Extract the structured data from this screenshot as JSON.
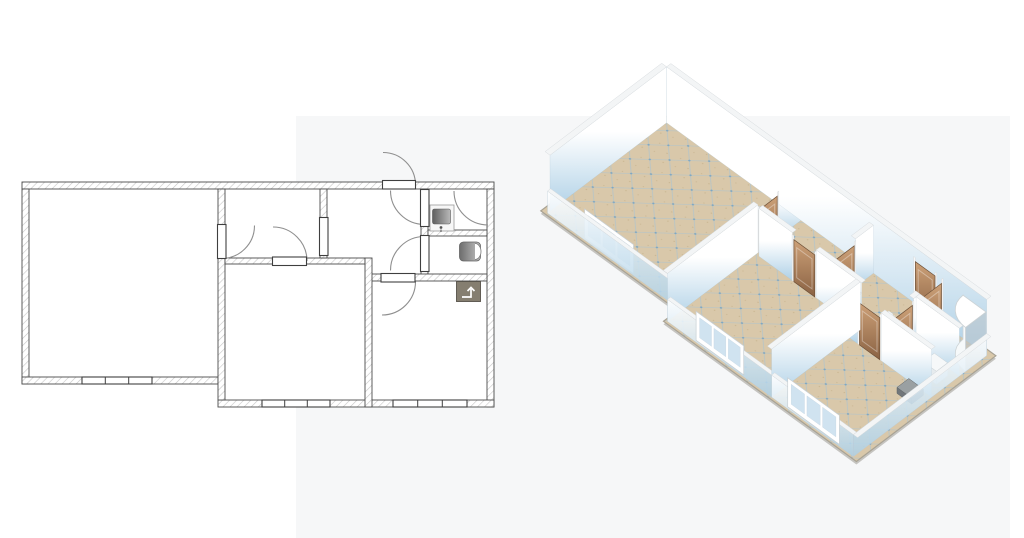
{
  "scene": {
    "width": 1024,
    "height": 538,
    "background": "#ffffff",
    "tint": {
      "x": 296,
      "y": 116,
      "w": 714,
      "h": 422,
      "color": "#eef0f2",
      "opacity": 0.5
    }
  },
  "plan2d": {
    "backing": {
      "x": 22,
      "y": 182,
      "w": 472,
      "h": 225,
      "color": "#ffffff"
    },
    "wall_fill": "#ffffff",
    "wall_stroke": "#4b4b4b",
    "hatch_color": "#c6c6c6",
    "bar_stroke": "#3f3f3f",
    "arc_color": "#8f8f8f",
    "walls": [
      [
        22,
        182,
        472,
        7
      ],
      [
        22,
        189,
        7,
        195
      ],
      [
        22,
        377,
        196,
        7
      ],
      [
        487,
        189,
        7,
        218
      ],
      [
        218,
        400,
        276,
        7
      ],
      [
        218,
        189,
        7,
        211
      ],
      [
        225,
        258,
        140,
        6
      ],
      [
        320,
        189,
        7,
        69
      ],
      [
        421,
        189,
        7,
        88
      ],
      [
        428,
        230,
        59,
        6
      ],
      [
        368,
        274,
        119,
        7
      ],
      [
        365,
        258,
        7,
        149
      ]
    ],
    "door_bars": [
      {
        "name": "entrance-door",
        "bar": [
          382.5,
          180.5,
          33,
          8.5
        ],
        "arc": {
          "from": [
            383,
            152.5
          ],
          "to": [
            415.5,
            185
          ],
          "r": 32.5,
          "sweep": 1
        }
      },
      {
        "name": "living-room-door",
        "bar": [
          217.5,
          224.5,
          8.5,
          34
        ],
        "arc": {
          "from": [
            254.5,
            225.5
          ],
          "to": [
            221.5,
            258.5
          ],
          "r": 33,
          "sweep": 1
        }
      },
      {
        "name": "bedroom-door",
        "bar": [
          272.5,
          257,
          34,
          8.5
        ],
        "arc": {
          "from": [
            273,
            227
          ],
          "to": [
            307,
            261
          ],
          "r": 34,
          "sweep": 1
        }
      },
      {
        "name": "bathroom-door",
        "bar": [
          420.5,
          189.5,
          8.5,
          37
        ],
        "arc": {
          "from": [
            390.5,
            190.5
          ],
          "to": [
            424.5,
            224.5
          ],
          "r": 34,
          "sweep": 0
        }
      },
      {
        "name": "toilet-door",
        "bar": [
          420.5,
          235.5,
          8.5,
          36
        ],
        "arc": {
          "from": [
            424.5,
            236.5
          ],
          "to": [
            390.5,
            270.5
          ],
          "r": 34,
          "sweep": 0
        }
      },
      {
        "name": "second-bedroom-door",
        "bar": [
          381,
          273.5,
          34,
          8.5
        ],
        "arc": {
          "from": [
            415.5,
            281.5
          ],
          "to": [
            382,
            315
          ],
          "r": 33.5,
          "sweep": 1
        }
      }
    ],
    "openings": [
      {
        "name": "hall-cased-opening",
        "bar": [
          319.5,
          217.5,
          8.5,
          38
        ]
      }
    ],
    "windows": [
      {
        "bar": [
          82,
          377,
          70,
          7
        ],
        "dividers": [
          105.3,
          128.7
        ]
      },
      {
        "bar": [
          262,
          400,
          68,
          7
        ],
        "dividers": [
          284.7,
          307.3
        ]
      },
      {
        "bar": [
          393,
          400,
          74,
          7
        ],
        "dividers": [
          417.7,
          442.3
        ]
      }
    ],
    "shower_arc": {
      "from": [
        454,
        191
      ],
      "to": [
        488,
        225
      ],
      "r": 34,
      "sweep": 0
    },
    "fixtures": {
      "sink": {
        "counter": [
          430,
          205,
          24,
          26
        ],
        "basin": [
          432.5,
          209,
          18,
          15
        ],
        "faucet": [
          441,
          227.5
        ],
        "counter_stroke": "#9a9a9a",
        "basin_dark": "#5f5f5f",
        "basin_light": "#b9b9b9"
      },
      "wc": {
        "body": [
          459.5,
          242,
          21,
          19
        ],
        "lid": [
          475,
          243.5,
          6,
          16
        ],
        "dark": "#6d6d6d",
        "light": "#c2c2c2"
      },
      "appliance": {
        "box": [
          456.5,
          281.5,
          24,
          20
        ],
        "fill": "#857e70",
        "stroke": "#57524a",
        "arrow": "M 462,297 L 471,297 L 471,289",
        "arrow_head": "M 467.5,291 L 471,287.5 L 474.5,291",
        "arrow_color": "#ffffff"
      }
    }
  },
  "plan3d": {
    "projection": {
      "origin": [
        666,
        116
      ],
      "ex": [
        0.699,
        0.508
      ],
      "ey": [
        -0.62,
        0.47
      ]
    },
    "heights": {
      "full": 56,
      "mid": 48,
      "low": 22,
      "door": 42,
      "post": 46,
      "win_bottom": 2,
      "win_top": 31,
      "pane_bottom": 7,
      "pane_top": 27
    },
    "colors": {
      "shadow": "#8a867c",
      "floor_base": "#d9c8aa",
      "floor_speckle": "#c8b48e",
      "grid_line": "#a9c3d2",
      "grid_dot": "#7fa7c1",
      "floor_edge": "#a8a294",
      "wall_top": "#f3f5f6",
      "wall_top_stroke": "#d7dbde",
      "wall_grad_top": "#ffffff",
      "wall_grad_bottom": "#aed0e6",
      "low_grad_top": "rgba(255,255,255,0.92)",
      "low_grad_bottom": "rgba(173,208,230,0.85)",
      "low_stroke": "rgba(185,203,214,0.7)",
      "wood_light": "#cda178",
      "wood_dark": "#8a6243",
      "wood_stroke": "#6e5138",
      "door_panel": "rgba(255,255,255,0.35)",
      "post_fill": "#f7f8f8",
      "post_stroke": "#d8dbdd",
      "win_frame": "#ffffff",
      "win_frame_stroke": "#c9d0d4",
      "win_pane": "#cde1ef",
      "shower_side": "#f6f9fa",
      "shower_top": "#ffffff",
      "shower_stroke": "#ccd3d6",
      "shower_glass": "rgba(185,195,200,0.55)"
    },
    "footprint": [
      [
        0,
        0
      ],
      [
        472,
        0
      ],
      [
        472,
        225
      ],
      [
        196,
        225
      ],
      [
        196,
        202
      ],
      [
        0,
        202
      ]
    ],
    "walls": [
      {
        "f": [
          7,
          7
        ],
        "t": [
          465,
          7
        ],
        "h": "full",
        "tv": [
          0,
          -7
        ]
      },
      {
        "f": [
          7,
          7
        ],
        "t": [
          7,
          195
        ],
        "h": "full",
        "tv": [
          -7,
          0
        ]
      },
      {
        "f": [
          199,
          7
        ],
        "t": [
          199,
          43
        ],
        "h": "mid",
        "tv": [
          -6,
          0
        ]
      },
      {
        "f": [
          199,
          76
        ],
        "t": [
          199,
          222
        ],
        "h": "mid",
        "tv": [
          -6,
          0
        ]
      },
      {
        "f": [
          203,
          79
        ],
        "t": [
          251,
          79
        ],
        "h": "mid",
        "tv": [
          0,
          -6
        ]
      },
      {
        "f": [
          285,
          79
        ],
        "t": [
          350,
          79
        ],
        "h": "mid",
        "tv": [
          0,
          -6
        ]
      },
      {
        "f": [
          303,
          7
        ],
        "t": [
          303,
          36
        ],
        "h": "mid",
        "tv": [
          -6,
          0
        ]
      },
      {
        "f": [
          403,
          45
        ],
        "t": [
          403,
          55
        ],
        "h": "mid",
        "tv": [
          -6,
          0
        ]
      },
      {
        "f": [
          403,
          88
        ],
        "t": [
          403,
          96
        ],
        "h": "mid",
        "tv": [
          -6,
          0
        ]
      },
      {
        "f": [
          403,
          51
        ],
        "t": [
          465,
          51
        ],
        "h": "mid",
        "tv": [
          0,
          -6
        ]
      },
      {
        "f": [
          348,
          96
        ],
        "t": [
          360,
          96
        ],
        "h": "mid",
        "tv": [
          0,
          -6
        ]
      },
      {
        "f": [
          393,
          96
        ],
        "t": [
          465,
          96
        ],
        "h": "mid",
        "tv": [
          0,
          -6
        ]
      },
      {
        "f": [
          348,
          79
        ],
        "t": [
          348,
          222
        ],
        "h": "mid",
        "tv": [
          -6,
          0
        ]
      },
      {
        "f": [
          7,
          199
        ],
        "t": [
          196,
          199
        ],
        "h": "low",
        "tv": [
          0,
          -5
        ]
      },
      {
        "f": [
          199,
          222
        ],
        "t": [
          348,
          222
        ],
        "h": "low",
        "tv": [
          0,
          -5
        ]
      },
      {
        "f": [
          348,
          222
        ],
        "t": [
          465,
          222
        ],
        "h": "low",
        "tv": [
          0,
          -5
        ]
      },
      {
        "f": [
          465,
          7
        ],
        "t": [
          465,
          222
        ],
        "h": "low",
        "tv": [
          6,
          0
        ]
      }
    ],
    "doors": [
      {
        "name": "entrance-door",
        "f": [
          361,
          7
        ],
        "t": [
          393,
          7
        ]
      },
      {
        "name": "living-room-door",
        "f": [
          199,
          43
        ],
        "t": [
          199,
          76
        ]
      },
      {
        "name": "bedroom-door",
        "f": [
          251,
          79
        ],
        "t": [
          285,
          79
        ]
      },
      {
        "name": "hall-opening-door",
        "f": [
          303,
          36
        ],
        "t": [
          303,
          73
        ]
      },
      {
        "name": "bathroom-door",
        "f": [
          403,
          8
        ],
        "t": [
          403,
          45
        ]
      },
      {
        "name": "toilet-door",
        "f": [
          403,
          55
        ],
        "t": [
          403,
          88
        ]
      },
      {
        "name": "second-bedroom-door",
        "f": [
          360,
          96
        ],
        "t": [
          393,
          96
        ]
      }
    ],
    "windows": [
      {
        "f": [
          60,
          199
        ],
        "t": [
          130,
          199
        ]
      },
      {
        "f": [
          240,
          222
        ],
        "t": [
          308,
          222
        ]
      },
      {
        "f": [
          371,
          222
        ],
        "t": [
          445,
          222
        ]
      }
    ],
    "fixtures": [
      {
        "type": "shower",
        "center": [
          465,
          8
        ],
        "r": 33,
        "h": 44
      },
      {
        "type": "prism",
        "rect": [
          409,
          26,
          429,
          45
        ],
        "h": 15,
        "top": "#f2f5f6",
        "side": "#dde4e7",
        "stroke": "#c9d1d5"
      },
      {
        "type": "prism",
        "rect": [
          437,
          60,
          456,
          78
        ],
        "h": 13,
        "top": "#f6f8f9",
        "side": "#e6ebee",
        "stroke": "#ccd3d7"
      },
      {
        "type": "prism",
        "rect": [
          436,
          100,
          457,
          119
        ],
        "h": 6,
        "top": "#9aa0a2",
        "side": "#71767a",
        "stroke": "#5f6467"
      }
    ]
  }
}
